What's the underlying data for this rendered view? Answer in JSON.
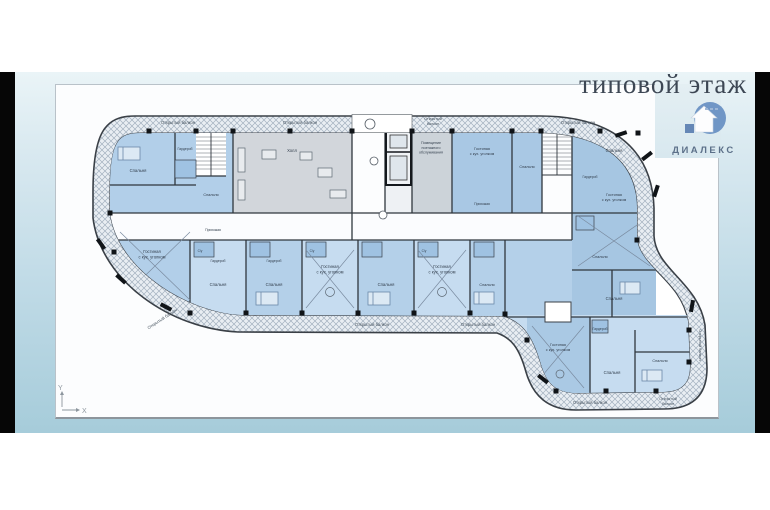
{
  "page": {
    "title": "типовой этаж"
  },
  "logo": {
    "text": "ДИАЛЕКС",
    "circle_color": "#7096c6",
    "text_color": "#5c7089"
  },
  "plan": {
    "axis": {
      "x": "X",
      "y": "Y"
    },
    "colors": {
      "band_hatch_bg": "#e9eef3",
      "band_hatch_line": "#a3b1bf",
      "apartment_blue": "#b2cfe9",
      "apartment_blue_alt": "#c6dcf0",
      "apartment_blue_deep": "#a6c6e2",
      "common_gray": "#d2d6db",
      "wall": "#2f363d",
      "bath_blue": "#9fc2e2"
    },
    "balcony_labels": [
      {
        "lines": [
          "Открытый балкон"
        ],
        "x": 178,
        "y": 124,
        "s": 4.2
      },
      {
        "lines": [
          "Открытый балкон"
        ],
        "x": 300,
        "y": 124,
        "s": 4.2
      },
      {
        "lines": [
          "Открытый",
          "балкон"
        ],
        "x": 433,
        "y": 120,
        "s": 3.8
      },
      {
        "lines": [
          "Открытый балкон"
        ],
        "x": 578,
        "y": 124,
        "s": 4.2
      },
      {
        "lines": [
          "Открытый балкон"
        ],
        "x": 163,
        "y": 320,
        "s": 4.2,
        "r": -33
      },
      {
        "lines": [
          "Открытый балкон"
        ],
        "x": 372,
        "y": 326,
        "s": 4.2
      },
      {
        "lines": [
          "Открытый балкон"
        ],
        "x": 478,
        "y": 326,
        "s": 4.2
      },
      {
        "lines": [
          "Открытый балкон"
        ],
        "x": 590,
        "y": 404,
        "s": 4.2
      },
      {
        "lines": [
          "Открытый",
          "балкон"
        ],
        "x": 668,
        "y": 400,
        "s": 3.8
      },
      {
        "lines": [
          "Открытый балкон"
        ],
        "x": 699,
        "y": 345,
        "s": 3.8,
        "r": 90
      }
    ],
    "room_labels": [
      {
        "lines": [
          "Спальня"
        ],
        "x": 138,
        "y": 172,
        "s": 4.2
      },
      {
        "lines": [
          "Гардероб"
        ],
        "x": 185,
        "y": 150,
        "s": 3.4
      },
      {
        "lines": [
          "Спальня"
        ],
        "x": 211,
        "y": 196,
        "s": 3.8
      },
      {
        "lines": [
          "Гостиная",
          "с кух. уголком"
        ],
        "x": 152,
        "y": 253,
        "s": 4.2
      },
      {
        "lines": [
          "Прихожая"
        ],
        "x": 213,
        "y": 231,
        "s": 3.4
      },
      {
        "lines": [
          "Холл"
        ],
        "x": 292,
        "y": 152,
        "s": 4.2
      },
      {
        "lines": [
          "Помещение",
          "поэтажного",
          "обслуживания"
        ],
        "x": 431,
        "y": 144,
        "s": 3.6
      },
      {
        "lines": [
          "Гостиная",
          "с кух. уголком"
        ],
        "x": 482,
        "y": 150,
        "s": 3.8
      },
      {
        "lines": [
          "Прихожая"
        ],
        "x": 482,
        "y": 205,
        "s": 3.4
      },
      {
        "lines": [
          "Спальня"
        ],
        "x": 527,
        "y": 168,
        "s": 3.8
      },
      {
        "lines": [
          "Спальня"
        ],
        "x": 614,
        "y": 152,
        "s": 4.2
      },
      {
        "lines": [
          "Гардероб"
        ],
        "x": 590,
        "y": 178,
        "s": 3.4
      },
      {
        "lines": [
          "Гостиная",
          "с кух. уголком"
        ],
        "x": 614,
        "y": 196,
        "s": 3.8
      },
      {
        "lines": [
          "Спальня"
        ],
        "x": 600,
        "y": 258,
        "s": 3.8
      },
      {
        "lines": [
          "Спальня"
        ],
        "x": 614,
        "y": 300,
        "s": 4.2
      },
      {
        "lines": [
          "Гардероб"
        ],
        "x": 218,
        "y": 262,
        "s": 3.4
      },
      {
        "lines": [
          "Спальня"
        ],
        "x": 218,
        "y": 286,
        "s": 4.2
      },
      {
        "lines": [
          "Гардероб"
        ],
        "x": 274,
        "y": 262,
        "s": 3.4
      },
      {
        "lines": [
          "Спальня"
        ],
        "x": 274,
        "y": 286,
        "s": 4.2
      },
      {
        "lines": [
          "Гостиная",
          "с кух. уголком"
        ],
        "x": 330,
        "y": 268,
        "s": 4.2
      },
      {
        "lines": [
          "Спальня"
        ],
        "x": 386,
        "y": 286,
        "s": 4.2
      },
      {
        "lines": [
          "Гостиная",
          "с кух. уголком"
        ],
        "x": 442,
        "y": 268,
        "s": 4.2
      },
      {
        "lines": [
          "Спальня"
        ],
        "x": 487,
        "y": 286,
        "s": 3.8
      },
      {
        "lines": [
          "С/у"
        ],
        "x": 200,
        "y": 252,
        "s": 3.2
      },
      {
        "lines": [
          "С/у"
        ],
        "x": 312,
        "y": 252,
        "s": 3.2
      },
      {
        "lines": [
          "С/у"
        ],
        "x": 424,
        "y": 252,
        "s": 3.2
      },
      {
        "lines": [
          "Гостиная",
          "с кух. уголком"
        ],
        "x": 558,
        "y": 346,
        "s": 3.8
      },
      {
        "lines": [
          "Гардероб"
        ],
        "x": 600,
        "y": 330,
        "s": 3.4
      },
      {
        "lines": [
          "Спальня"
        ],
        "x": 612,
        "y": 374,
        "s": 4.2
      },
      {
        "lines": [
          "Спальня"
        ],
        "x": 660,
        "y": 362,
        "s": 3.8
      }
    ],
    "columns": [
      [
        149,
        131
      ],
      [
        196,
        131
      ],
      [
        233,
        131
      ],
      [
        290,
        131
      ],
      [
        352,
        131
      ],
      [
        412,
        131
      ],
      [
        452,
        131
      ],
      [
        512,
        131
      ],
      [
        541,
        131
      ],
      [
        572,
        131
      ],
      [
        600,
        131
      ],
      [
        638,
        133
      ],
      [
        190,
        313
      ],
      [
        246,
        313
      ],
      [
        302,
        313
      ],
      [
        358,
        313
      ],
      [
        414,
        313
      ],
      [
        470,
        313
      ],
      [
        505,
        314
      ],
      [
        556,
        391
      ],
      [
        606,
        391
      ],
      [
        656,
        391
      ],
      [
        689,
        330
      ],
      [
        689,
        362
      ],
      [
        637,
        240
      ],
      [
        527,
        340
      ],
      [
        110,
        213
      ],
      [
        114,
        252
      ]
    ],
    "wall_marks": [
      [
        101,
        244,
        55
      ],
      [
        121,
        279,
        42
      ],
      [
        166,
        307,
        28
      ],
      [
        621,
        134,
        -18
      ],
      [
        647,
        156,
        -38
      ],
      [
        656,
        191,
        -72
      ],
      [
        692,
        306,
        -80
      ],
      [
        543,
        379,
        38
      ]
    ],
    "grid_bubbles": [
      [
        370,
        124,
        5
      ],
      [
        374,
        161,
        4
      ],
      [
        383,
        215,
        4
      ]
    ]
  }
}
